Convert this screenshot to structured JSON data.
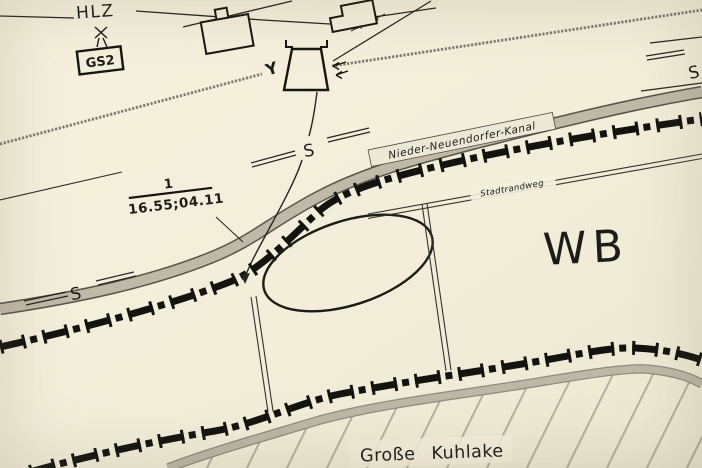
{
  "map": {
    "colors": {
      "paper": "#f3efdc",
      "ink": "#17160f",
      "canal_fill": "#bfb9a8",
      "canal_edge": "#57544a",
      "fence_gray": "#7d7a6e",
      "band_fill": "#bcb7a6",
      "hatch": "#a5a191"
    },
    "labels": {
      "fence_left": "HLZ",
      "box_marker": "GS2",
      "distance": "40m",
      "y_mast": "Y",
      "s_marker": "S",
      "canal": "Nieder-Neuendorfer-Kanal",
      "path": "Stadtrandweg",
      "boundary_marker_top": "1",
      "boundary_marker_bottom": "16.55;04.11",
      "area": "WB",
      "water": "Große Kuhlake"
    }
  }
}
